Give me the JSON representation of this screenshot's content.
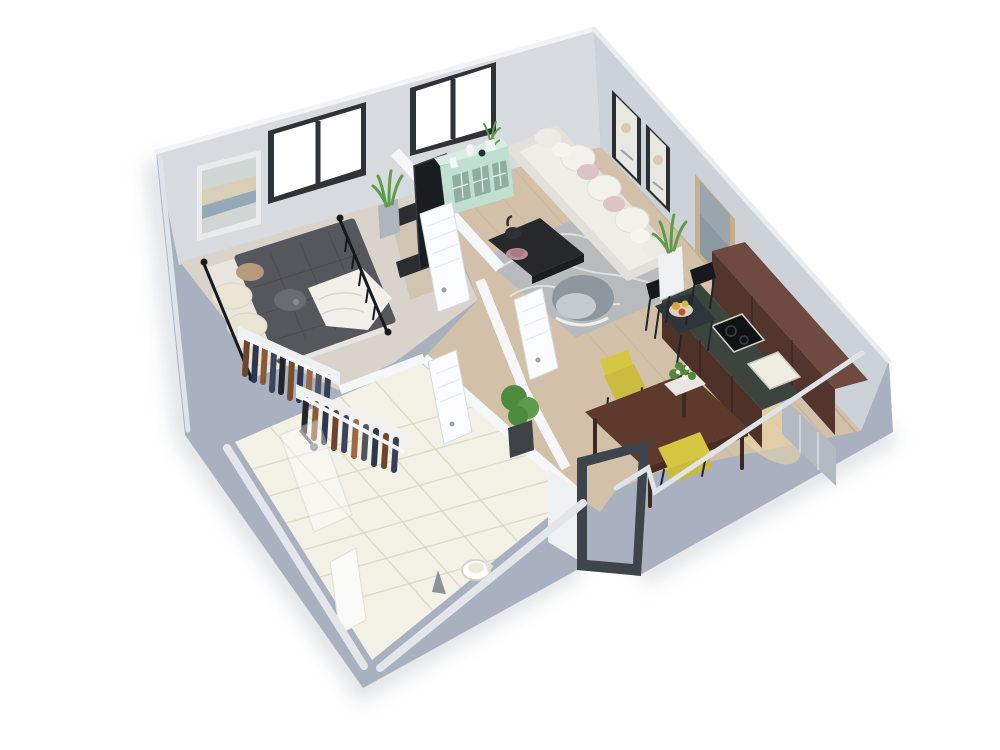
{
  "scene": {
    "type": "3d-floor-plan-render",
    "description": "Isometric dollhouse-style 3D rendering of a one-bedroom apartment on a white background",
    "rooms": [
      {
        "name": "bedroom",
        "items": [
          "double-bed",
          "black-metal-bed-frame",
          "cream-pillows",
          "dark-gray-duvet",
          "white-throw-blanket",
          "abstract-wall-art",
          "tv-stand",
          "tv",
          "snake-plant",
          "open-closet-clothes-rails"
        ]
      },
      {
        "name": "living-room",
        "items": [
          "white-sofa",
          "pink-cushions",
          "gray-rug",
          "black-coffee-table",
          "teapot",
          "pink-bowl",
          "gray-armchair",
          "two-gallery-frames",
          "large-wall-art",
          "floor-plant",
          "mint-sideboard",
          "black-bistro-table",
          "two-black-chairs",
          "fruit-tray"
        ]
      },
      {
        "name": "kitchen",
        "items": [
          "dark-wood-wall-cabinets",
          "island-counter",
          "black-cooktop",
          "white-sink",
          "stainless-fridge",
          "under-cabinet-warm-lighting"
        ]
      },
      {
        "name": "dining-area",
        "items": [
          "dark-wood-dining-table",
          "two-yellow-chairs",
          "white-flower-centerpiece"
        ]
      },
      {
        "name": "bathroom",
        "items": [
          "round-toilet",
          "walk-in-shower",
          "glass-screen",
          "cream-tile-floor",
          "floor-drain-cone"
        ]
      },
      {
        "name": "hallway",
        "items": [
          "potted-plant",
          "white-interior-doors"
        ]
      }
    ],
    "window_count": 2,
    "interior_white_doors": 3,
    "entry_doors_dark_frame": 1
  },
  "colors": {
    "background": "#ffffff",
    "wall_exterior": "#a9b1c1",
    "wall_nw": "#d7dade",
    "wall_ne": "#cdd2d8",
    "floor_wood": "#d2c1a8",
    "floor_bedroom": "#d9d3cb",
    "floor_tile": "#f3f0e5",
    "partition_white": "#f5f6f8",
    "bed_duvet": "#56575c",
    "mattress": "#e8e5df",
    "pillow_cream": "#eae4d3",
    "sofa_white": "#efede8",
    "cushion_pink": "#dcc3c8",
    "rug_gray": "#b7bbbe",
    "coffee_table_black": "#26292c",
    "armchair_gray": "#8f979e",
    "chair_yellow": "#d6c742",
    "dining_table_wood": "#5d3a2b",
    "cabinet_brown": "#54352d",
    "cabinet_top_brown": "#6f4a40",
    "island_top": "#3c443e",
    "island_front": "#4e3129",
    "counter_glow": "#ecd9a6",
    "fridge_steel": "#b4bac1",
    "sideboard_mint": "#bfe0d0",
    "sideboard_mint_top": "#d8ece3",
    "plant_green": "#5f9b4c",
    "plant_green_dark": "#4c8a3c",
    "frame_dark": "#2b2f33",
    "art_frame_tan": "#c7b089",
    "art_content_bluegray": "#8c98a2",
    "door_frame_dark": "#3e444b",
    "metal_black": "#17191c",
    "window_frame": "#2e3338",
    "clothes_brown": "#6e452c",
    "clothes_navy": "#2c3750",
    "clothes_tan": "#9b6a42",
    "clothes_gray": "#50565f"
  }
}
